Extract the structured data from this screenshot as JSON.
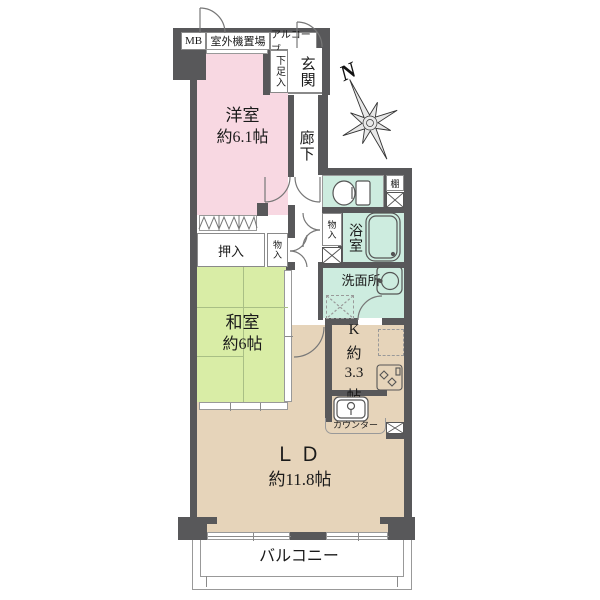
{
  "compass": {
    "north": "N"
  },
  "exterior": {
    "mb": "MB",
    "outdoor_unit": "室外機置場",
    "alcove": "アルコーブ",
    "balcony": "バルコニー"
  },
  "entrance": {
    "hall": "玄関",
    "shoe_cabinet": "下足入"
  },
  "corridor": {
    "label": "廊下"
  },
  "rooms": {
    "western": {
      "name": "洋室",
      "size": "約6.1帖"
    },
    "japanese": {
      "name": "和室",
      "size": "約6帖"
    },
    "living_dining": {
      "name": "ＬＤ",
      "size": "約11.8帖"
    },
    "kitchen": {
      "chars": [
        "K",
        "約",
        "3.3",
        "帖"
      ]
    }
  },
  "wet_areas": {
    "bathroom": "浴室",
    "washroom": "洗面所",
    "shelf": "棚"
  },
  "storage": {
    "oshiire": "押入",
    "monoire_hall_left": "物入",
    "monoire_hall_right": "物入"
  },
  "kitchen_fixtures": {
    "counter": "カウンター"
  },
  "colors": {
    "wall": "#58585a",
    "western_room": "#f8d8e2",
    "japanese_room": "#d9eda6",
    "wet_room": "#cdecdf",
    "living_dining": "#e6d4ba"
  }
}
